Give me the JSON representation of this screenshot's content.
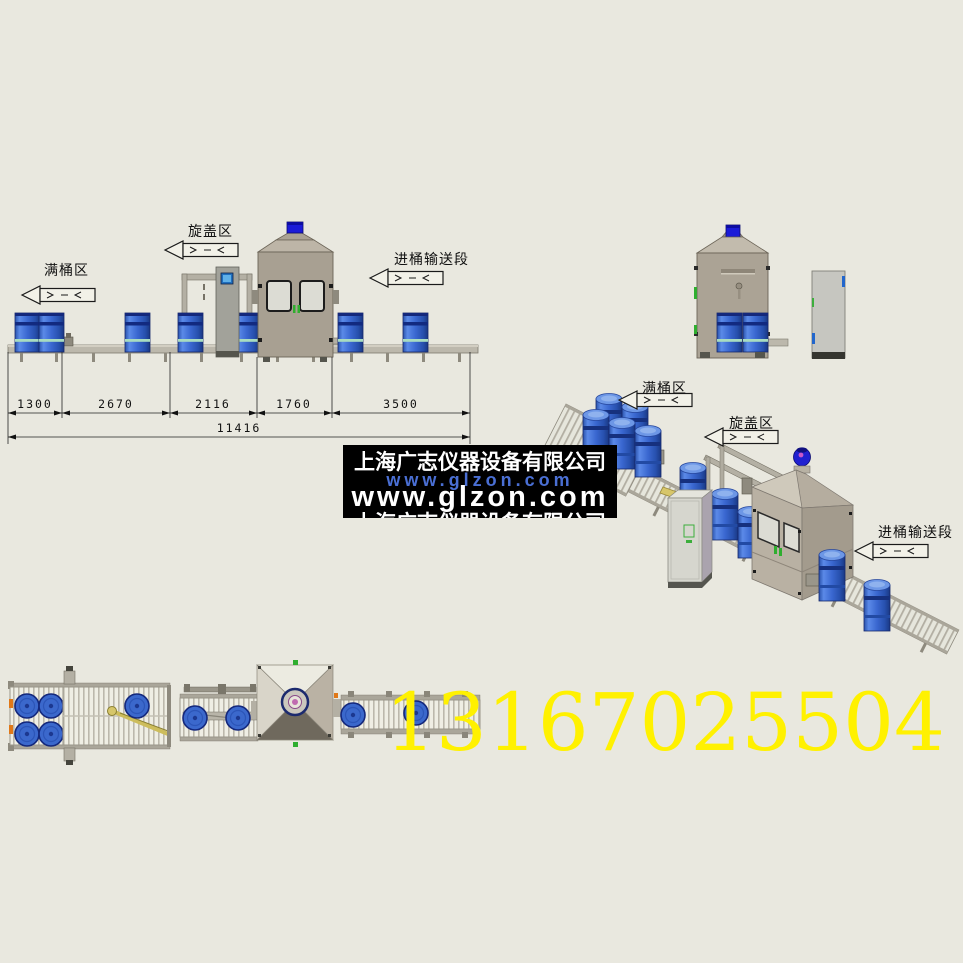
{
  "page": {
    "background": "#e9e8df"
  },
  "labels": {
    "full_drum_area": "满桶区",
    "capping_area": "旋盖区",
    "infeed_section": "进桶输送段"
  },
  "elevation": {
    "dimensions": {
      "segments": [
        "1300",
        "2670",
        "2116",
        "1760",
        "3500"
      ],
      "total": "11416"
    }
  },
  "watermark": {
    "company": "上海广志仪器设备有限公司",
    "website_small": "www.glzon.com",
    "website_large": "www.glzon.com",
    "company_repeat": "上海广志仪器设备有限公司",
    "background": "#000000",
    "url_color": "#4a6fd4"
  },
  "phone": {
    "number": "13167025504",
    "color": "#fff100"
  },
  "colors": {
    "drum_blue": "#3b68cc",
    "drum_dark": "#16276b",
    "cabin_tan": "#a8a092",
    "beacon_blue": "#1b1bd8",
    "conveyor_gray": "#bcb8ac",
    "diverter_yellow": "#d7c66a",
    "accent_green": "#2fae2f",
    "accent_orange": "#e07818"
  }
}
